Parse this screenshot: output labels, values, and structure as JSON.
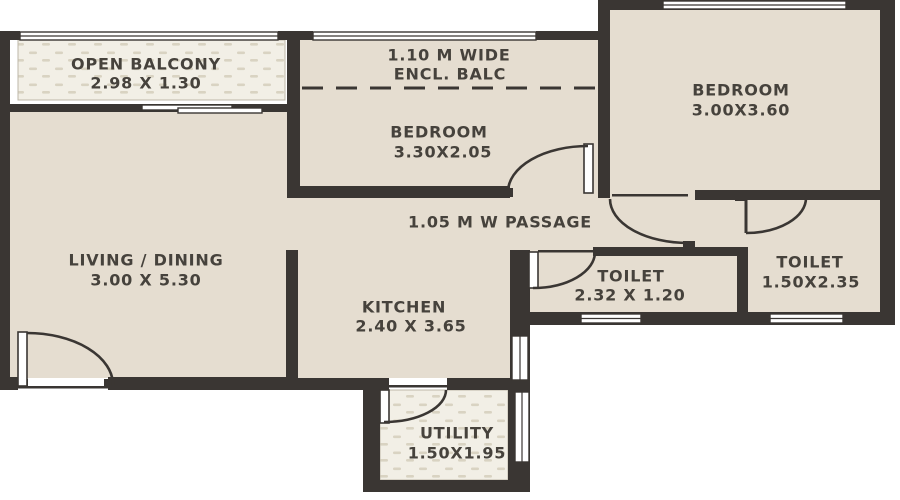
{
  "rooms": {
    "open_balcony": {
      "label": "OPEN BALCONY",
      "dims": "2.98 X 1.30"
    },
    "enclosed_balcony": {
      "label_line1": "1.10 M WIDE",
      "label_line2": "ENCL. BALC"
    },
    "bedroom_1": {
      "label": "BEDROOM",
      "dims": "3.30X2.05"
    },
    "bedroom_2": {
      "label": "BEDROOM",
      "dims": "3.00X3.60"
    },
    "living_dining": {
      "label": "LIVING / DINING",
      "dims": "3.00 X 5.30"
    },
    "passage": {
      "label": "1.05 M W PASSAGE"
    },
    "kitchen": {
      "label": "KITCHEN",
      "dims": "2.40 X 3.65"
    },
    "toilet_1": {
      "label": "TOILET",
      "dims": "2.32 X 1.20"
    },
    "toilet_2": {
      "label": "TOILET",
      "dims": "1.50X2.35"
    },
    "utility": {
      "label": "UTILITY",
      "dims": "1.50X1.95"
    }
  },
  "colors": {
    "wall": "#3a3633",
    "floor": "#e5ddd0",
    "hatch_background": "#f2efe6",
    "hatch_dash": "#d9d3c2",
    "window": "#ffffff",
    "text": "#46423c",
    "background": "#ffffff"
  }
}
